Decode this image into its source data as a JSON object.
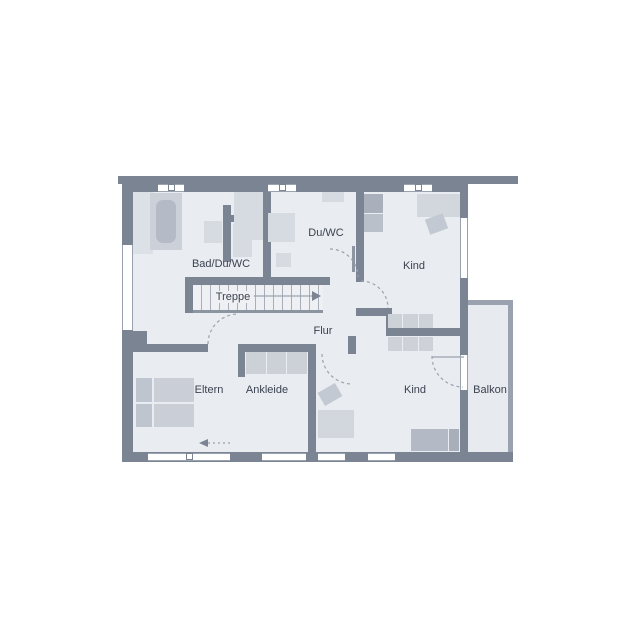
{
  "plan": {
    "title": "Obergeschoss Grundriss",
    "rooms": [
      {
        "id": "bad",
        "label": "Bad/Du/WC"
      },
      {
        "id": "duwc",
        "label": "Du/WC"
      },
      {
        "id": "kind-oben",
        "label": "Kind"
      },
      {
        "id": "treppe",
        "label": "Treppe"
      },
      {
        "id": "flur",
        "label": "Flur"
      },
      {
        "id": "eltern",
        "label": "Eltern"
      },
      {
        "id": "ankleide",
        "label": "Ankleide"
      },
      {
        "id": "kind-unten",
        "label": "Kind"
      },
      {
        "id": "balkon",
        "label": "Balkon"
      }
    ],
    "colors": {
      "wall": "#7b8492",
      "floor": "#e9ecf1",
      "balcony_floor": "#e7eaee",
      "outline": "#9aa2af",
      "furniture_light": "#d6dae1",
      "furniture_mid": "#c7ccd5",
      "furniture_dark": "#a9b0bc",
      "text": "#3b4250"
    },
    "icons": [
      "bathtub-icon",
      "shower-icon",
      "sink-icon",
      "toilet-icon",
      "bed-icon",
      "wardrobe-icon",
      "desk-icon",
      "chair-icon",
      "door-arc-icon",
      "stair-arrow-icon",
      "entrance-arrow-icon"
    ]
  }
}
